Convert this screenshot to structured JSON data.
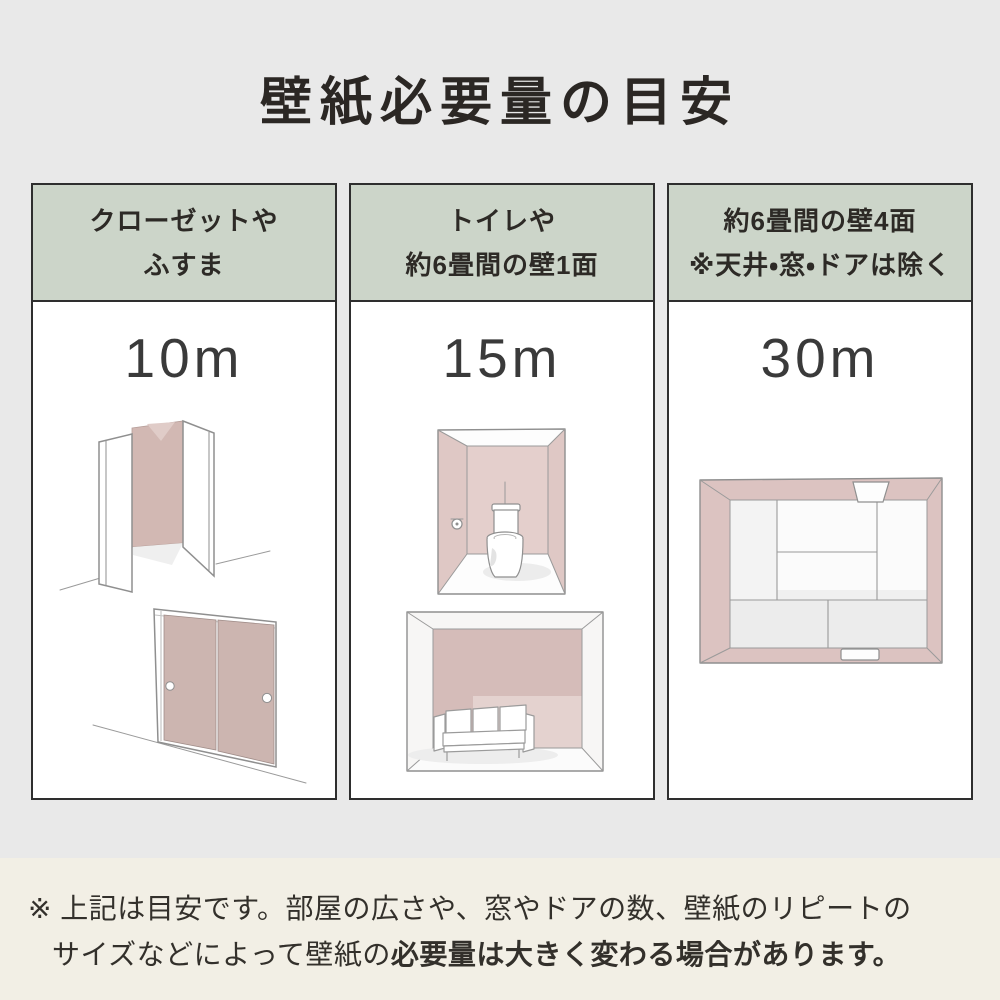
{
  "title": "壁紙必要量の目安",
  "colors": {
    "bg": "#e9e9e9",
    "footer_bg": "#f2efe5",
    "header_green": "#ccd5c9",
    "panel_white": "#ffffff",
    "border_dark": "#2e2e2e",
    "text_dark": "#2b2724",
    "amount_color": "#3a3a3a",
    "wall_pink": "#d5bcb7"
  },
  "columns": [
    {
      "header_line1": "クローゼットや",
      "header_line2": "ふすま",
      "amount": "10m",
      "illustrations": [
        "open-closet",
        "fusuma-sliding-doors"
      ]
    },
    {
      "header_line1": "トイレや",
      "header_line2": "約6畳間の壁1面",
      "amount": "15m",
      "illustrations": [
        "toilet-room",
        "room-one-accent-wall-sofa"
      ]
    },
    {
      "header_line1": "約6畳間の壁4面",
      "header_line2": "※天井・窓・ドアは除く",
      "amount": "30m",
      "illustrations": [
        "six-tatami-room-top-view"
      ]
    }
  ],
  "footnote": {
    "line1": "※ 上記は目安です。部屋の広さや、窓やドアの数、壁紙のリピートの",
    "line2_normal": "サイズなどによって壁紙の",
    "line2_bold": "必要量は大きく変わる場合があります。"
  }
}
